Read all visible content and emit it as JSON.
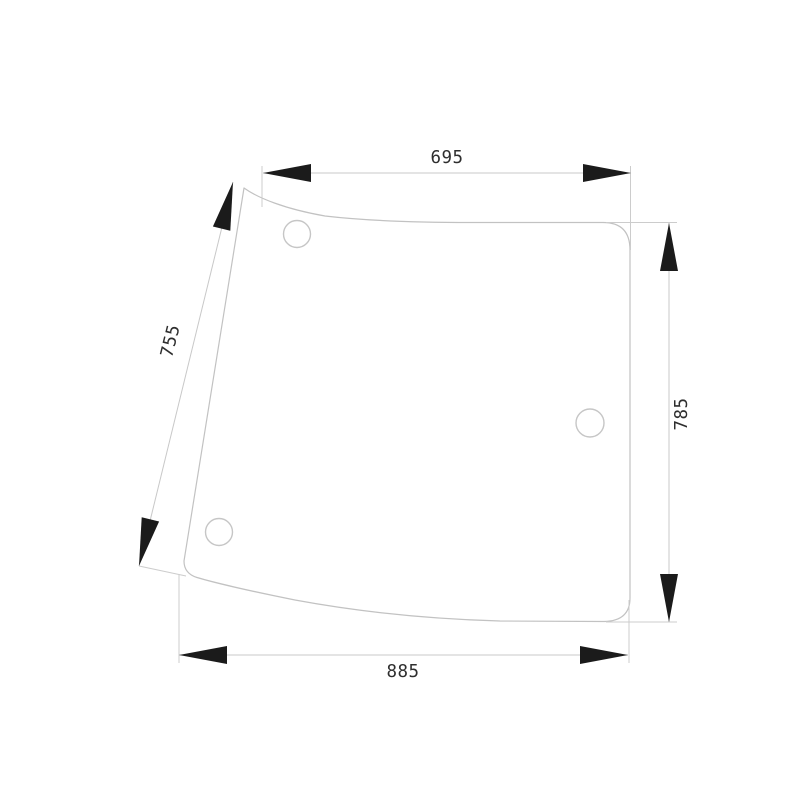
{
  "drawing": {
    "kind": "technical dimension drawing",
    "subject": "curved cab glass panel with three mounting holes",
    "dimensions": {
      "top": "695",
      "left_slant": "755",
      "right": "785",
      "bottom": "885"
    },
    "holes": 3,
    "colors": {
      "background": "#ffffff",
      "outline": "#c2c2c2",
      "dimension_line": "#c8c8c8",
      "arrow": "#1b1b1b",
      "label_text": "#2e2e2e"
    }
  }
}
